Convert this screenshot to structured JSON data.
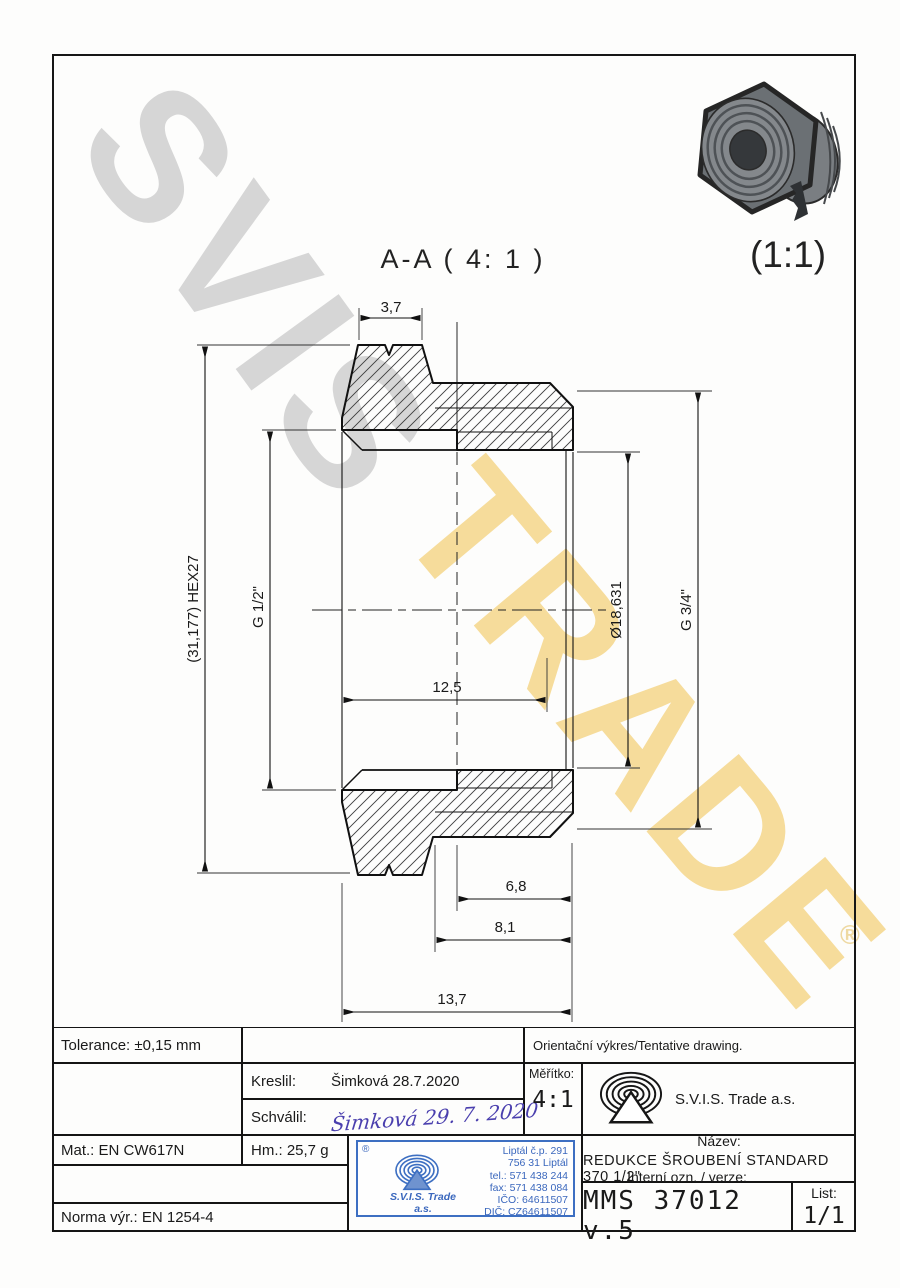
{
  "watermark": {
    "line1": "SVIS",
    "line2": "TRADE",
    "registered": "®",
    "gray": "#d6d6d6",
    "yellow": "#f6dc9b"
  },
  "views": {
    "section_title": "A-A ( 4: 1 )",
    "iso_scale": "(1:1)"
  },
  "dimensions": {
    "top_width": "3,7",
    "hex_height": "(31,177) HEX27",
    "thread_internal": "G 1/2\"",
    "bore_diameter": "Ø18,631",
    "thread_external": "G 3/4\"",
    "bore_depth": "12,5",
    "len_inner": "6,8",
    "len_mid": "8,1",
    "len_total": "13,7"
  },
  "title_block": {
    "tolerance": "Tolerance: ±0,15 mm",
    "orientation_note": "Orientační výkres/Tentative drawing.",
    "kreslil_label": "Kreslil:",
    "kreslil_value": "Šimková 28.7.2020",
    "schvalil_label": "Schválil:",
    "schvalil_signature": "Šimková 29. 7. 2020",
    "meritko_label": "Měřítko:",
    "meritko_value": "4:1",
    "company": "S.V.I.S. Trade a.s.",
    "mat": "Mat.: EN CW617N",
    "hm": "Hm.: 25,7 g",
    "norma": "Norma výr.: EN 1254-4",
    "nazev_label": "Název:",
    "nazev_value": "REDUKCE ŠROUBENÍ STANDARD 370 1/2\"",
    "interni_label": "Interní ozn. / verze:",
    "interni_value": "MMS 37012 v.5",
    "list_label": "List:",
    "list_value": "1/1"
  },
  "stamp": {
    "registered": "®",
    "logo_text": "S.V.I.S. Trade",
    "logo_sub": "a.s.",
    "address_line1": "Liptál č.p. 291",
    "address_line2": "756 31 Liptál",
    "address_line3": "tel.: 571 438 244",
    "address_line4": "fax: 571 438 084",
    "address_line5": "IČO: 64611507",
    "address_line6": "DIČ: CZ64611507",
    "color": "#3d6fc2"
  },
  "ink": {
    "signature_color": "#4a3fae",
    "line_color": "#161616"
  }
}
